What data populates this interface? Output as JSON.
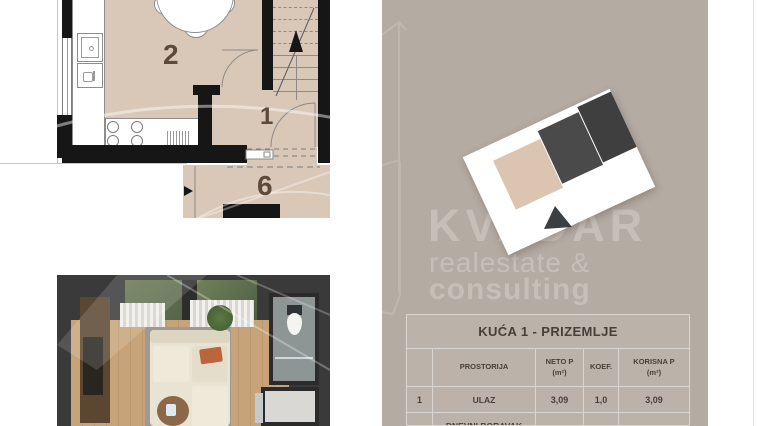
{
  "colors": {
    "panel_bg": "#b4aba3",
    "plan_room_fill": "#d9c7b8",
    "wall": "#161616",
    "watermark_text": "#c6bfb8",
    "card_beige": "#dcc5b0",
    "card_dark": "#464646",
    "table_cell_bg": "#bbb2aa",
    "table_text": "#474039",
    "room_label_text": "#5d4a3b"
  },
  "plan": {
    "rooms": [
      {
        "label": "2"
      },
      {
        "label": "1"
      },
      {
        "label": "6"
      }
    ]
  },
  "panel": {
    "watermark": {
      "brand": "KVADAR",
      "line2": "realestate &",
      "line3": "consulting"
    },
    "table": {
      "title": "KUĆA 1 - PRIZEMLJE",
      "headers": {
        "num": "",
        "room": "PROSTORIJA",
        "neto": "NETO P",
        "neto_unit": "(m²)",
        "koef": "KOEF.",
        "korisna": "KORISNA P",
        "korisna_unit": "(m²)"
      },
      "rows": [
        {
          "num": "1",
          "room": "ULAZ",
          "neto": "3,09",
          "koef": "1,0",
          "korisna": "3,09"
        },
        {
          "num": "",
          "room": "DNEVNI BORAVAK",
          "neto": "",
          "koef": "",
          "korisna": ""
        }
      ]
    }
  }
}
